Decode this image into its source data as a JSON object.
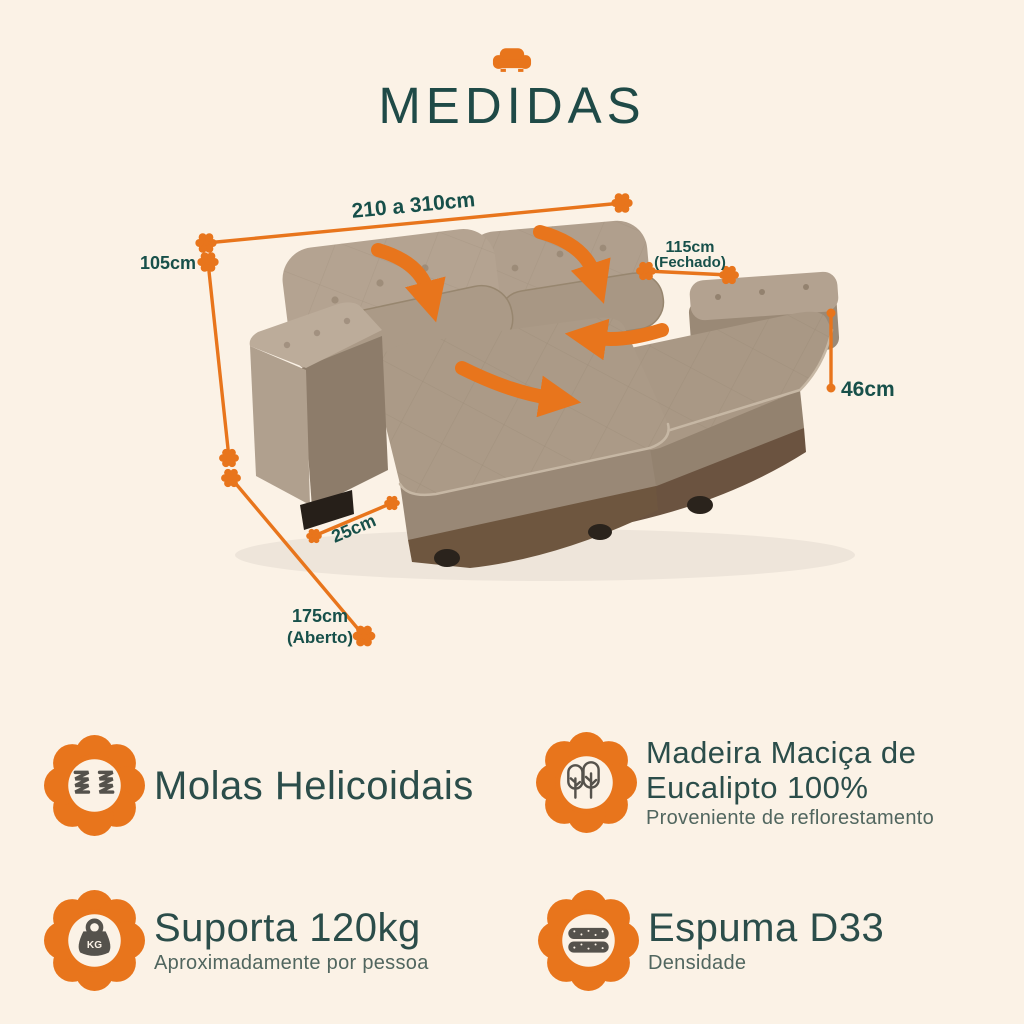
{
  "header": {
    "title": "MEDIDAS"
  },
  "colors": {
    "background": "#FBF2E6",
    "accent_orange": "#E8751C",
    "teal_text": "#17504A",
    "title_teal": "#1F4A47",
    "subtitle_gray": "#51665F",
    "icon_gray": "#55524C",
    "sofa_fabric": "#AB9A87",
    "sofa_base_brown": "#6B5340"
  },
  "measurements": {
    "width": {
      "label": "210 a 310cm"
    },
    "height": {
      "label": "105cm"
    },
    "depth_closed": {
      "label": "115cm",
      "sublabel": "(Fechado)"
    },
    "seat_height": {
      "label": "46cm"
    },
    "foot_depth": {
      "label": "25cm"
    },
    "depth_open": {
      "label": "175cm",
      "sublabel": "(Aberto)"
    }
  },
  "features": {
    "springs": {
      "title": "Molas Helicoidais"
    },
    "wood": {
      "title_line1": "Madeira Maciça de",
      "title_line2": "Eucalipto 100%",
      "subtitle": "Proveniente de reflorestamento"
    },
    "weight": {
      "title": "Suporta 120kg",
      "subtitle": "Aproximadamente por pessoa",
      "icon_text": "KG"
    },
    "foam": {
      "title": "Espuma D33",
      "subtitle": "Densidade"
    }
  }
}
